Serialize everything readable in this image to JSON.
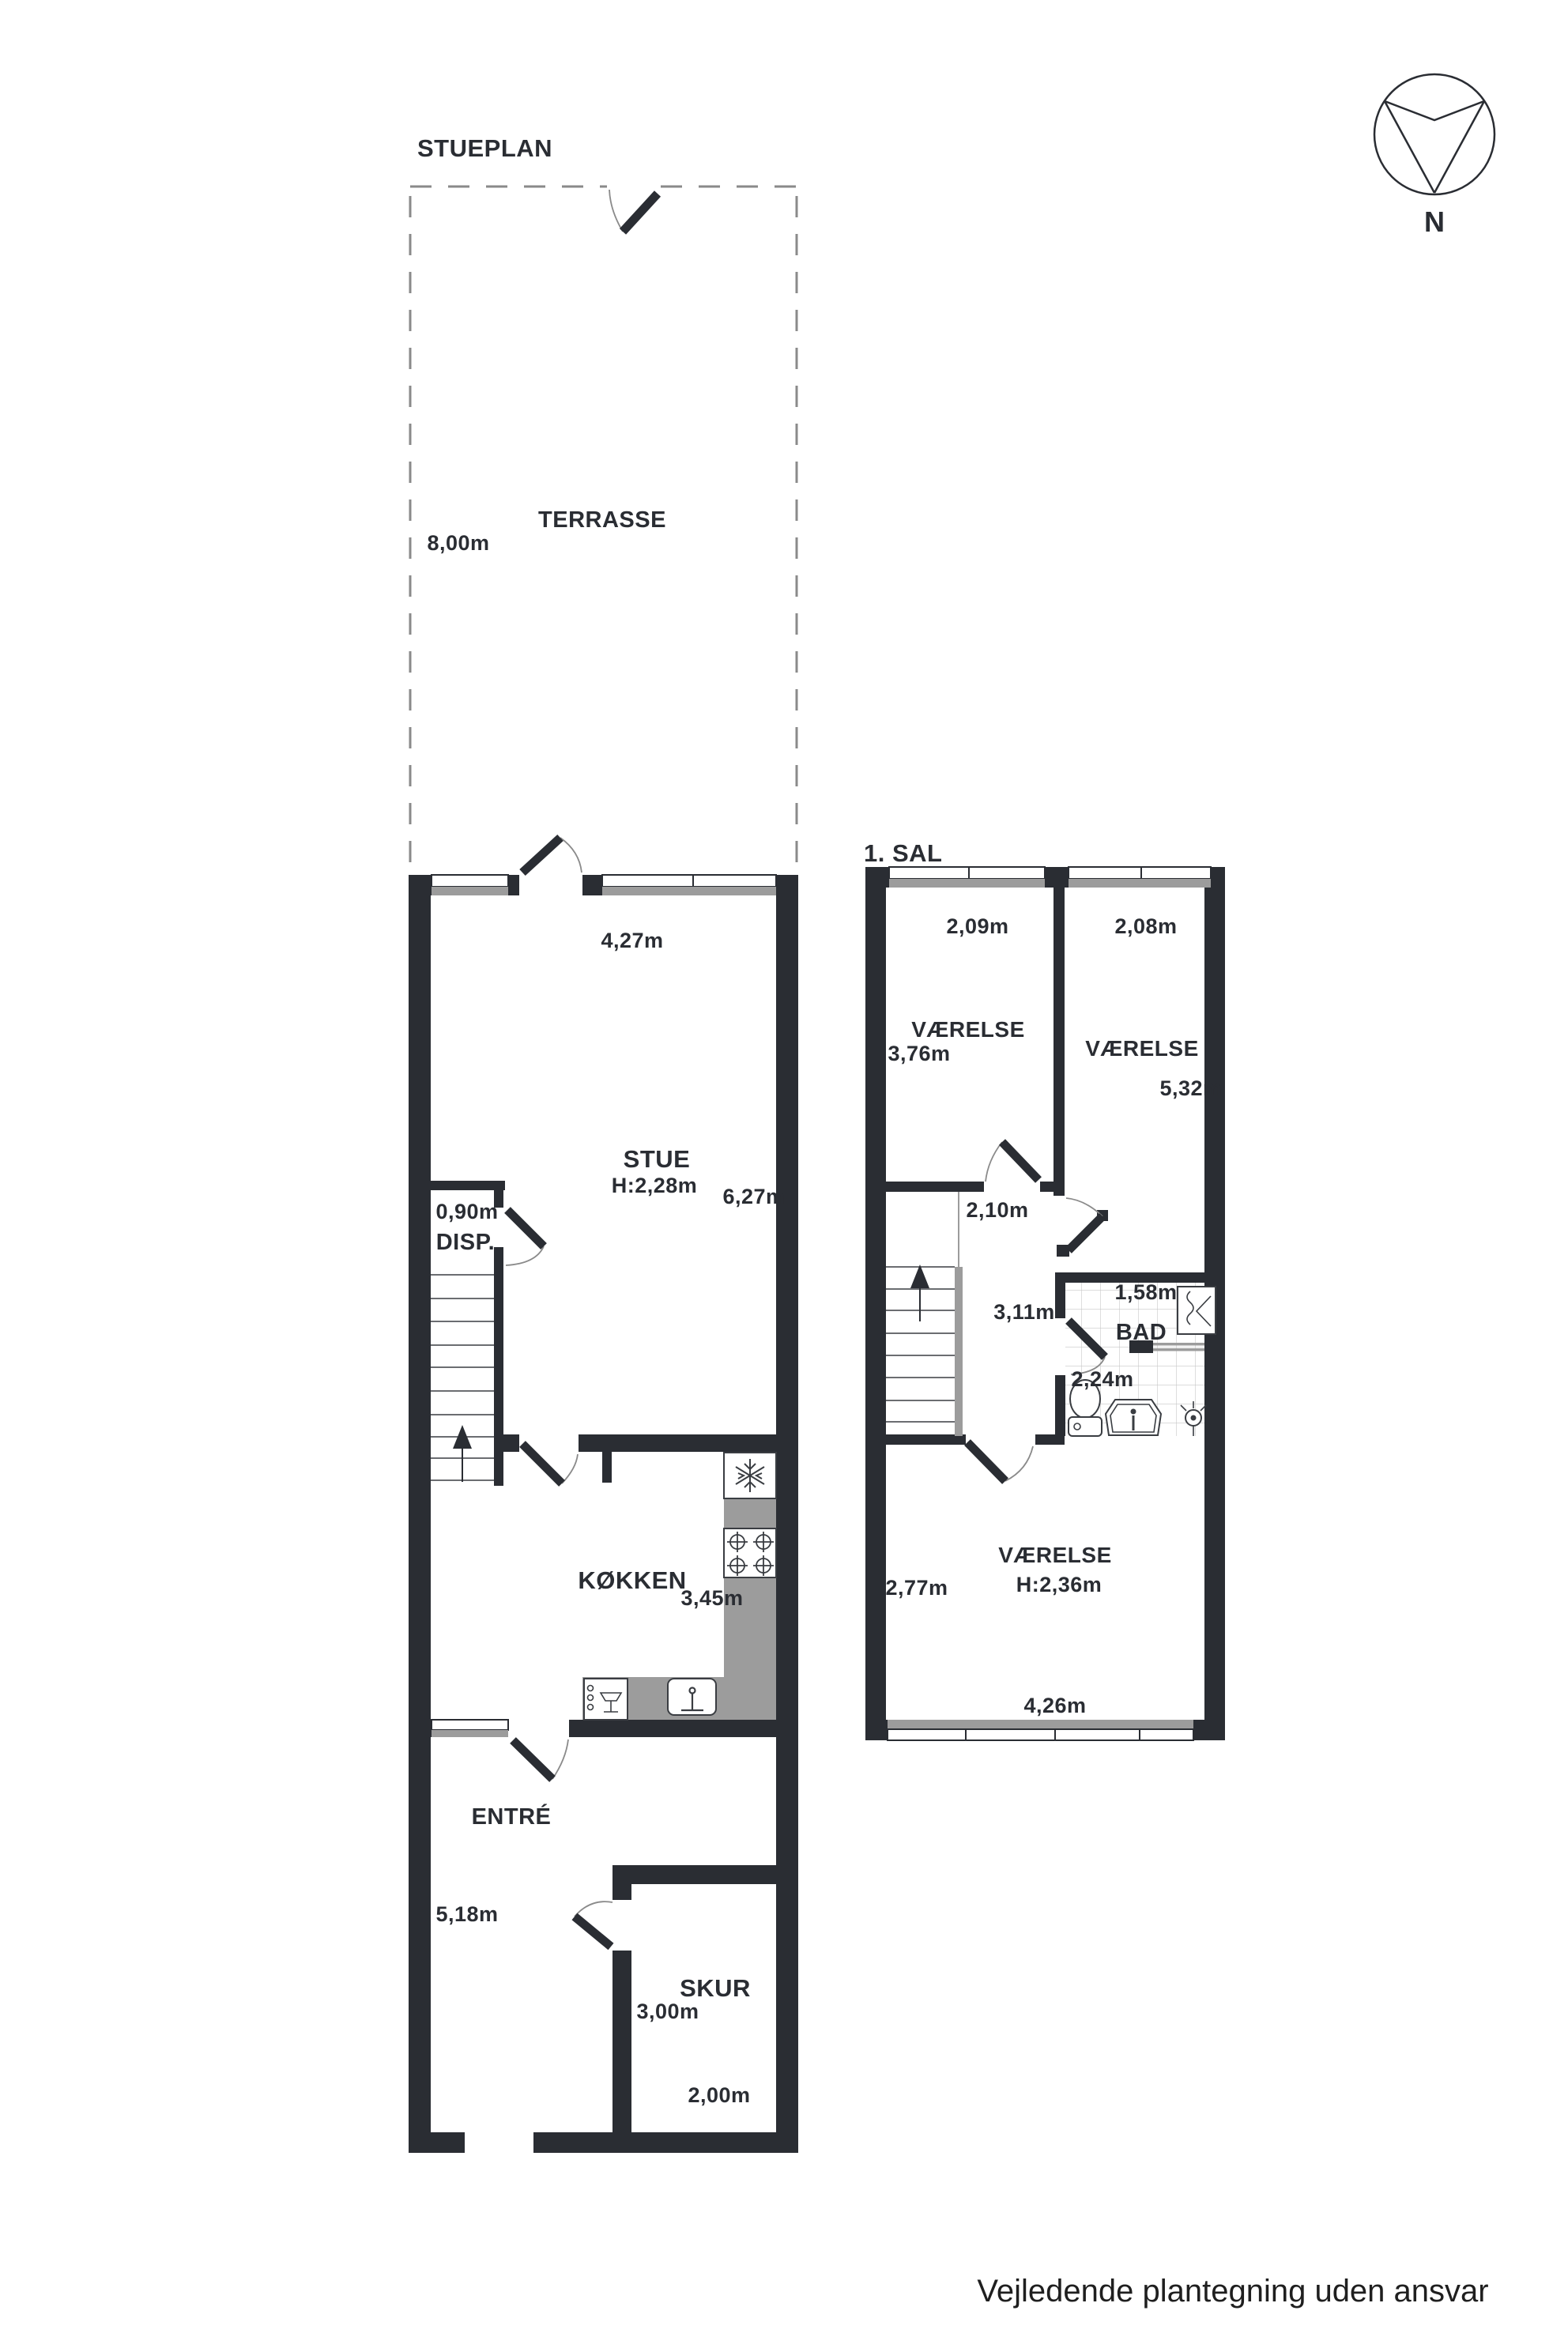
{
  "compass": {
    "label": "N"
  },
  "ground_floor": {
    "title": "STUEPLAN",
    "terrace": {
      "name": "TERRASSE",
      "depth": "8,00m"
    },
    "rooms": {
      "stue": {
        "name": "STUE",
        "ceiling": "H:2,28m",
        "width": "4,27m",
        "length": "6,27m"
      },
      "disp": {
        "name": "DISP.",
        "width": "0,90m"
      },
      "kitchen": {
        "name": "KØKKEN",
        "width": "3,45m"
      },
      "entre": {
        "name": "ENTRÉ",
        "length": "5,18m"
      },
      "shed": {
        "name": "SKUR",
        "length": "3,00m",
        "width": "2,00m"
      }
    }
  },
  "first_floor": {
    "title": "1. SAL",
    "rooms": {
      "room_nw": {
        "name": "VÆRELSE",
        "width": "2,09m",
        "length": "3,76m"
      },
      "room_ne": {
        "name": "VÆRELSE",
        "width": "2,08m",
        "length": "5,32m"
      },
      "landing": {
        "width": "2,10m",
        "length": "3,11m"
      },
      "bath": {
        "name": "BAD",
        "width": "1,58m",
        "depth": "2,24m"
      },
      "room_s": {
        "name": "VÆRELSE",
        "width": "2,77m",
        "ceiling": "H:2,36m",
        "length": "4,26m"
      }
    }
  },
  "footer": {
    "disclaimer": "Vejledende plantegning uden ansvar"
  },
  "colors": {
    "wall": "#2a2d33",
    "counter_gray": "#9c9c9c",
    "glass_gray": "#9c9c9c",
    "tile_line": "#c8c8c8",
    "dash_gray": "#8a8a8a",
    "background": "#ffffff"
  }
}
